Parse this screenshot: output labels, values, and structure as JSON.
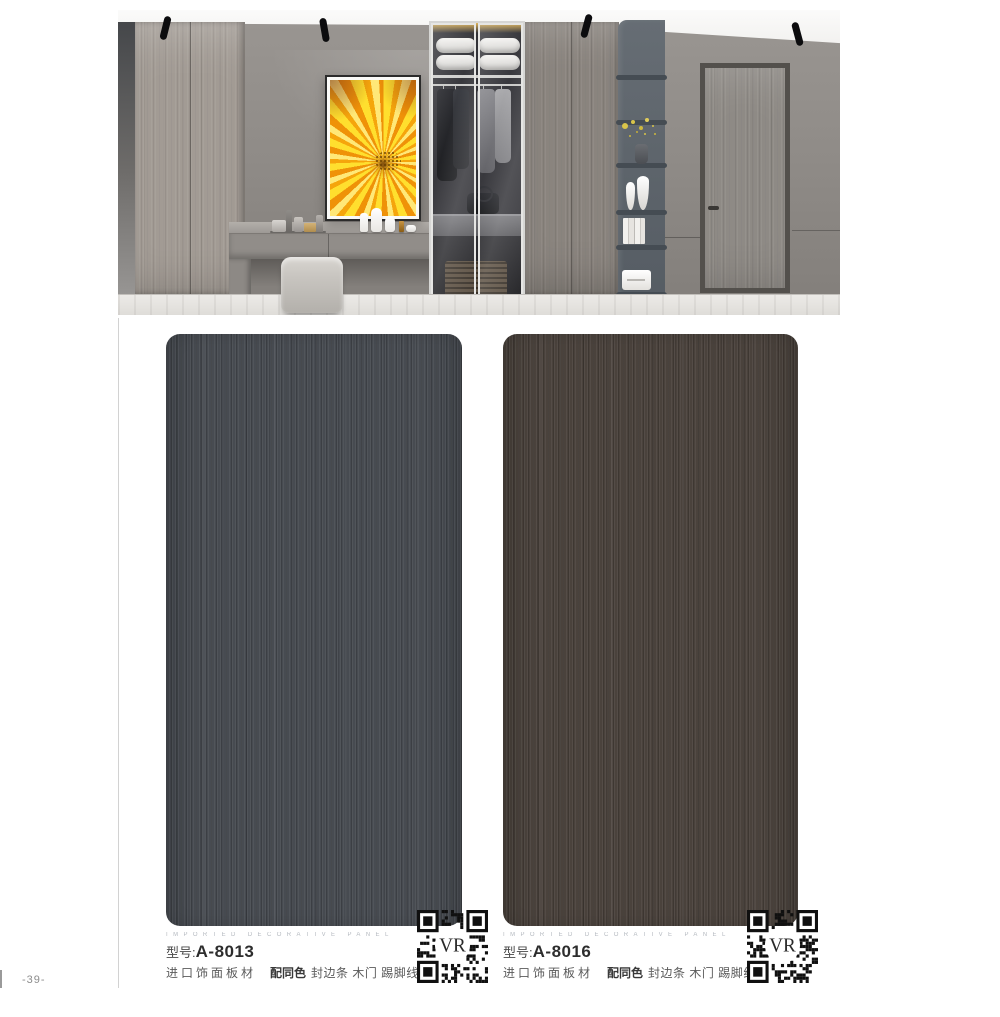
{
  "page": {
    "number": "-39-"
  },
  "colors": {
    "swatch_left": "#474b51",
    "swatch_right": "#4a423c",
    "eyebrow_gray": "#b5bac0",
    "artwork_yellow": "#fdc41c"
  },
  "swatches": [
    {
      "eyebrow": "IMPORTED DECORATIVE PANEL",
      "model_label": "型号:",
      "model_code": "A-8013",
      "desc_material": "进口饰面板材",
      "desc_bold": "配同色",
      "desc_rest": "封边条 木门 踢脚线",
      "qr_label": "VR",
      "color": "#474b51"
    },
    {
      "eyebrow": "IMPORTED DECORATIVE PANEL",
      "model_label": "型号:",
      "model_code": "A-8016",
      "desc_material": "进口饰面板材",
      "desc_bold": "配同色",
      "desc_rest": "封边条 木门 踢脚线",
      "qr_label": "VR",
      "color": "#4a423c"
    }
  ]
}
